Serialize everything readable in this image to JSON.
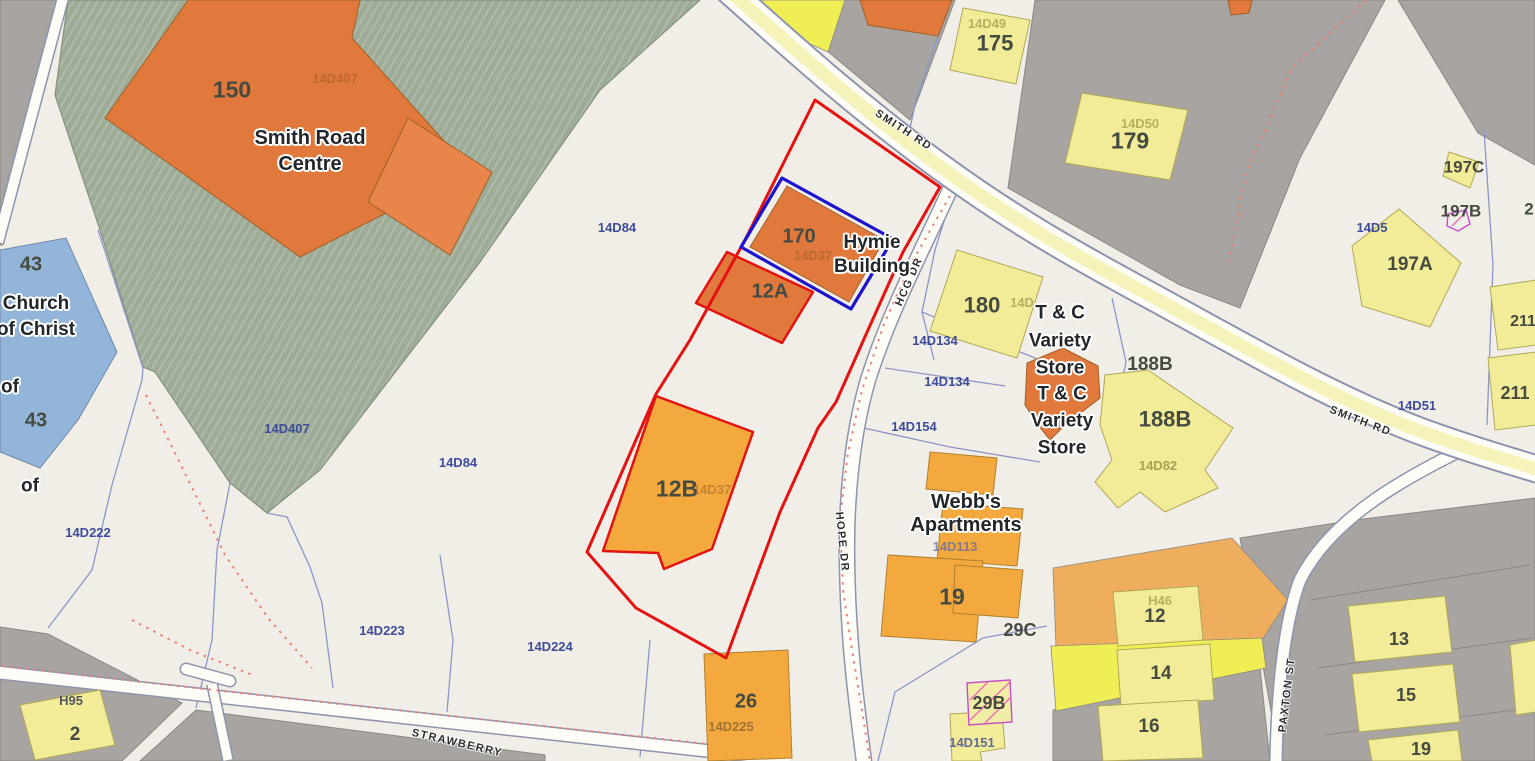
{
  "colors": {
    "background": "#f1eee7",
    "parcel_gray": "#a7a4a1",
    "parcel_green": "#9dab97",
    "parcel_green_hatch": "#aebaa7",
    "parcel_orange": "#efae5d",
    "parcel_yellow": "#f0ee55",
    "building_orange": "#e0793b",
    "building_orange_light": "#e8854a",
    "building_amber": "#f3a93d",
    "building_yellow": "#f2eb97",
    "building_blue": "#93b5d9",
    "road_fill": "#f6f3ba",
    "road_casing": "#8d94ad",
    "boundary_blue": "#8d95c8",
    "boundary_gray": "#8b8884",
    "selection_red": "#e51212",
    "selection_blue": "#1c13cf",
    "dotted_red": "#e8837b",
    "hatch_magenta": "#c44fc7",
    "hatch_pink": "#e871b4",
    "label_dark": "#454b41",
    "label_blue": "#3d4d9a",
    "label_name": "#22272b",
    "label_road": "#2d2d2d"
  },
  "roads": {
    "smith_rd_nw": "SMITH RD",
    "smith_rd_e": "SMITH RD",
    "hcg_dr": "HCG DR",
    "hope_dr": "HOPE DR",
    "paxton_st": "PAXTON ST",
    "strawberry": "STRAWBERRY"
  },
  "names": {
    "smith_road_centre": "Smith Road\nCentre",
    "hymie_building": "Hymie\nBuilding",
    "church_of_christ": "Church\nof Christ",
    "of_fragment": "of",
    "tc_variety_upper": "T & C\nVariety\nStore",
    "tc_variety_lower": "T & C\nVariety\nStore",
    "webbs_apartments": "Webb's\nApartments"
  },
  "buildings": {
    "b150": "150",
    "b43a": "43",
    "b43b": "43",
    "b170": "170",
    "b12a": "12A",
    "b12b": "12B",
    "b175": "175",
    "b179": "179",
    "b180": "180",
    "b188b_parcel": "188B",
    "b188b": "188B",
    "b197c": "197C",
    "b197b": "197B",
    "b197a": "197A",
    "b211a": "211",
    "b211b": "211",
    "b2_edge": "2",
    "b19_webbs": "19",
    "b29c": "29C",
    "b29b": "29B",
    "b26": "26",
    "b12": "12",
    "b14": "14",
    "b16": "16",
    "b13": "13",
    "b15": "15",
    "b19_se": "19",
    "b2_sw": "2"
  },
  "parcels": {
    "p14d84_a": "14D84",
    "p14d84_b": "14D84",
    "p14d222": "14D222",
    "p14d223": "14D223",
    "p14d224": "14D224",
    "p14d134_a": "14D134",
    "p14d134_b": "14D134",
    "p14d154": "14D154",
    "p14d51": "14D51",
    "p14d5": "14D5",
    "p14d151": "14D151",
    "p14d225": "14D225",
    "p14d407": "14D407",
    "p_h95": "H95"
  },
  "faint": {
    "f14d407": "14D407",
    "f14d49": "14D49",
    "f14d50": "14D50",
    "f14d": "14D",
    "f14d37_a": "14D37",
    "f14d37_b": "14D37",
    "f14d82": "14D82",
    "f14d113": "14D113",
    "f_h46": "H46"
  }
}
